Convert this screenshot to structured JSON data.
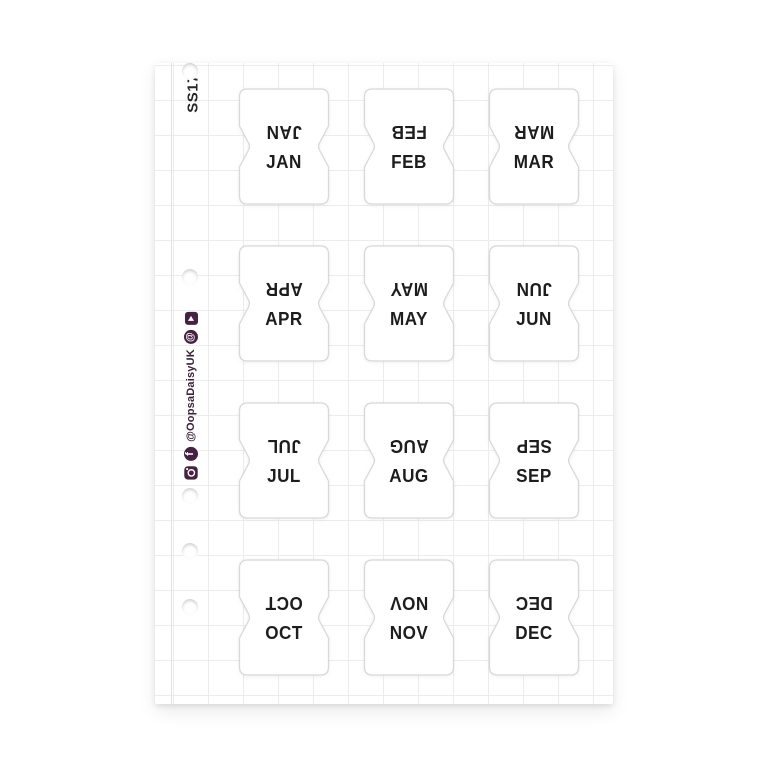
{
  "product": {
    "code": "SS173"
  },
  "branding": {
    "handle": "@OopsaDaisyUK",
    "icons": [
      "instagram-icon",
      "facebook-icon",
      "at-icon",
      "play-icon"
    ]
  },
  "sheet": {
    "type": "monthly-tab-sticker-sheet",
    "months": [
      "JAN",
      "FEB",
      "MAR",
      "APR",
      "MAY",
      "JUN",
      "JUL",
      "AUG",
      "SEP",
      "OCT",
      "NOV",
      "DEC"
    ],
    "hole_count": 6
  },
  "colors": {
    "accent_purple": "#452142",
    "label_ink": "#1d1d1d",
    "grid_line": "#ececec",
    "tab_outline": "#d8d8d8"
  }
}
